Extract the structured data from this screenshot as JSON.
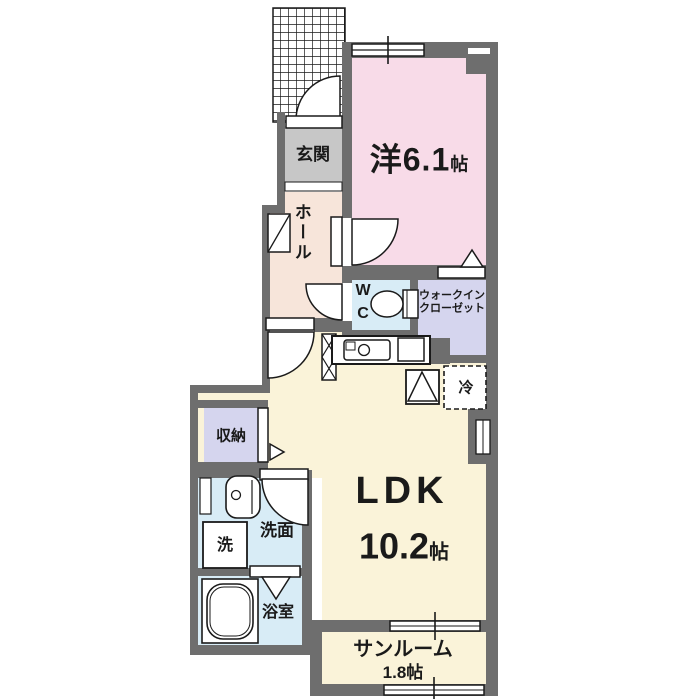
{
  "floorplan": {
    "title": "1LDK apartment floor plan",
    "rooms": {
      "genkan": {
        "label": "玄関"
      },
      "hall": {
        "label": "ホール"
      },
      "western": {
        "label": "洋6.1",
        "unit": "帖"
      },
      "wc": {
        "line1": "W",
        "line2": "C"
      },
      "wic": {
        "line1": "ウォークイン",
        "line2": "クローゼット"
      },
      "fridge": {
        "label": "冷"
      },
      "storage": {
        "label": "収納"
      },
      "washer": {
        "label": "洗"
      },
      "washroom": {
        "label": "洗面"
      },
      "bathroom": {
        "label": "浴室"
      },
      "ldk": {
        "name": "LDK",
        "size": "10.2",
        "unit": "帖"
      },
      "sunroom": {
        "name": "サンルーム",
        "size": "1.8帖"
      }
    },
    "colors": {
      "wall": "#6e6e6e",
      "western": "#f8dbe8",
      "hall": "#f7e5da",
      "genkan": "#c7c7c7",
      "water": "#d8ecf6",
      "closet": "#d5d5ee",
      "ldk": "#faf3d9",
      "line": "#1a1a1a",
      "white": "#ffffff"
    }
  }
}
